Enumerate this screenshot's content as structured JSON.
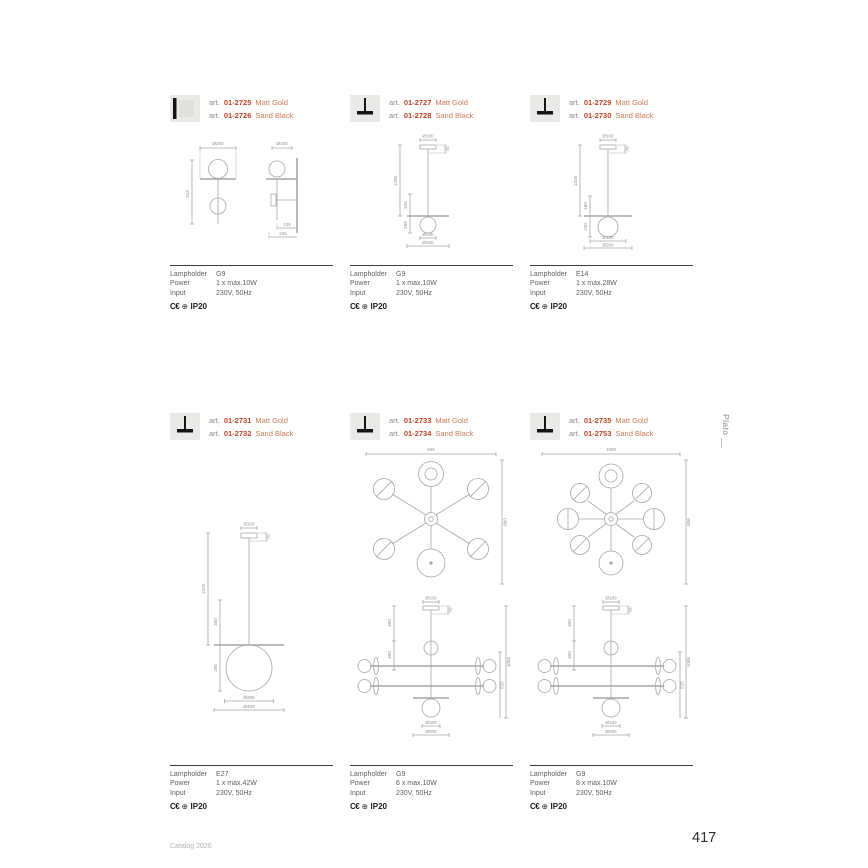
{
  "page": {
    "side_label": "Plato __",
    "footer_left": "Catalog 2026",
    "page_number": "417"
  },
  "labels": {
    "art": "art.",
    "lampholder": "Lampholder",
    "power": "Power",
    "input": "Input",
    "ce": "C€",
    "ip": "IP20"
  },
  "icons": {
    "globe": "⊕"
  },
  "colors": {
    "art_code": "#bf4526",
    "finish": "#cd7a55",
    "drawing_line": "#a6a6a6",
    "spec_text": "#5f5f5f",
    "spec_border": "#3c3c3c"
  },
  "products": [
    {
      "variants": [
        {
          "code": "01-2725",
          "finish": "Matt Gold"
        },
        {
          "code": "01-2726",
          "finish": "Sand Black"
        }
      ],
      "specs": {
        "lampholder": "G9",
        "power": "1 x max.10W",
        "input": "230V, 50Hz"
      },
      "dims": {
        "front_top": "Ø200",
        "front_h": "324",
        "side_top": "Ø100",
        "side_b1": "125",
        "side_b2": "225"
      }
    },
    {
      "variants": [
        {
          "code": "01-2727",
          "finish": "Matt Gold"
        },
        {
          "code": "01-2728",
          "finish": "Sand Black"
        }
      ],
      "specs": {
        "lampholder": "G9",
        "power": "1 x max.10W",
        "input": "230V, 50Hz"
      },
      "dims": {
        "top": "Ø100",
        "drop": "70",
        "h_total": "1285",
        "h_mid": "320",
        "h_low": "185",
        "b1": "Ø100",
        "b2": "Ø200"
      }
    },
    {
      "variants": [
        {
          "code": "01-2729",
          "finish": "Matt Gold"
        },
        {
          "code": "01-2730",
          "finish": "Sand Black"
        }
      ],
      "specs": {
        "lampholder": "E14",
        "power": "1 x max.28W",
        "input": "230V, 50Hz"
      },
      "dims": {
        "top": "Ø100",
        "drop": "70",
        "h_total": "1325",
        "h_mid": "160",
        "h_low": "100",
        "b1": "Ø150",
        "b2": "Ø200"
      }
    },
    {
      "variants": [
        {
          "code": "01-2731",
          "finish": "Matt Gold"
        },
        {
          "code": "01-2732",
          "finish": "Sand Black"
        }
      ],
      "specs": {
        "lampholder": "E27",
        "power": "1 x max.42W",
        "input": "230V, 50Hz"
      },
      "dims": {
        "top": "Ø100",
        "drop": "70",
        "h_total": "1325",
        "h_mid": "300",
        "h_low": "285",
        "b1": "Ø280",
        "b2": "Ø400"
      }
    },
    {
      "variants": [
        {
          "code": "01-2733",
          "finish": "Matt Gold"
        },
        {
          "code": "01-2734",
          "finish": "Sand Black"
        }
      ],
      "specs": {
        "lampholder": "G9",
        "power": "6 x max.10W",
        "input": "230V, 50Hz"
      },
      "dims": {
        "plan_w": "945",
        "plan_h": "860",
        "top": "Ø100",
        "drop": "70",
        "l1": "300",
        "l2": "300",
        "r1": "1065",
        "r2": "525",
        "b1": "Ø100",
        "b2": "Ø200"
      }
    },
    {
      "variants": [
        {
          "code": "01-2735",
          "finish": "Matt Gold"
        },
        {
          "code": "01-2753",
          "finish": "Sand Black"
        }
      ],
      "specs": {
        "lampholder": "G9",
        "power": "8 x max.10W",
        "input": "230V, 50Hz"
      },
      "dims": {
        "plan_w": "1060",
        "plan_h": "806",
        "top": "Ø100",
        "drop": "70",
        "l1": "300",
        "l2": "300",
        "r1": "1065",
        "r2": "525",
        "b1": "Ø100",
        "b2": "Ø200"
      }
    }
  ]
}
